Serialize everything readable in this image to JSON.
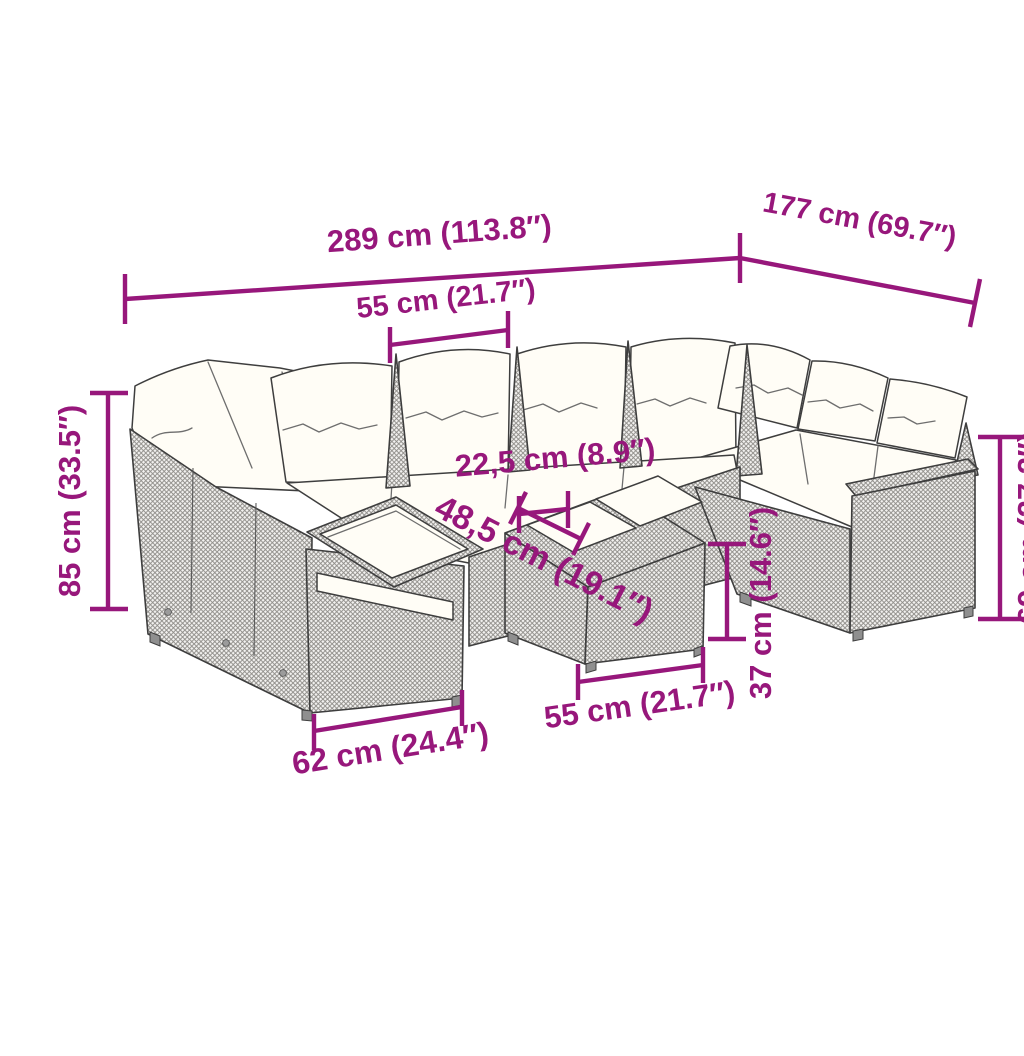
{
  "diagram": {
    "title": "Garden sofa set dimension diagram",
    "product": "poly-rattan lounge set with cushions, end table armrest and coffee table",
    "colors": {
      "dimension_accent": "#97177b",
      "outline": "#3e3e3e",
      "cushion": "#fffdf6",
      "rattan_texture_bg": "#f3f2f0",
      "rattan_texture_line": "#8f8d89",
      "background": "#ffffff"
    },
    "labels": {
      "overall_width": "289 cm (113.8″)",
      "overall_depth": "177 cm (69.7″)",
      "seat_width": "55 cm (21.7″)",
      "overall_height": "85 cm (33.5″)",
      "tray_width": "22,5 cm (8.9″)",
      "table_depth": "48,5 cm (19.1″)",
      "table_height": "37 cm (14.6″)",
      "armrest_height": "69 cm (27.2″)",
      "table_width": "55 cm (21.7″)",
      "end_section_width": "62 cm (24.4″)"
    }
  }
}
